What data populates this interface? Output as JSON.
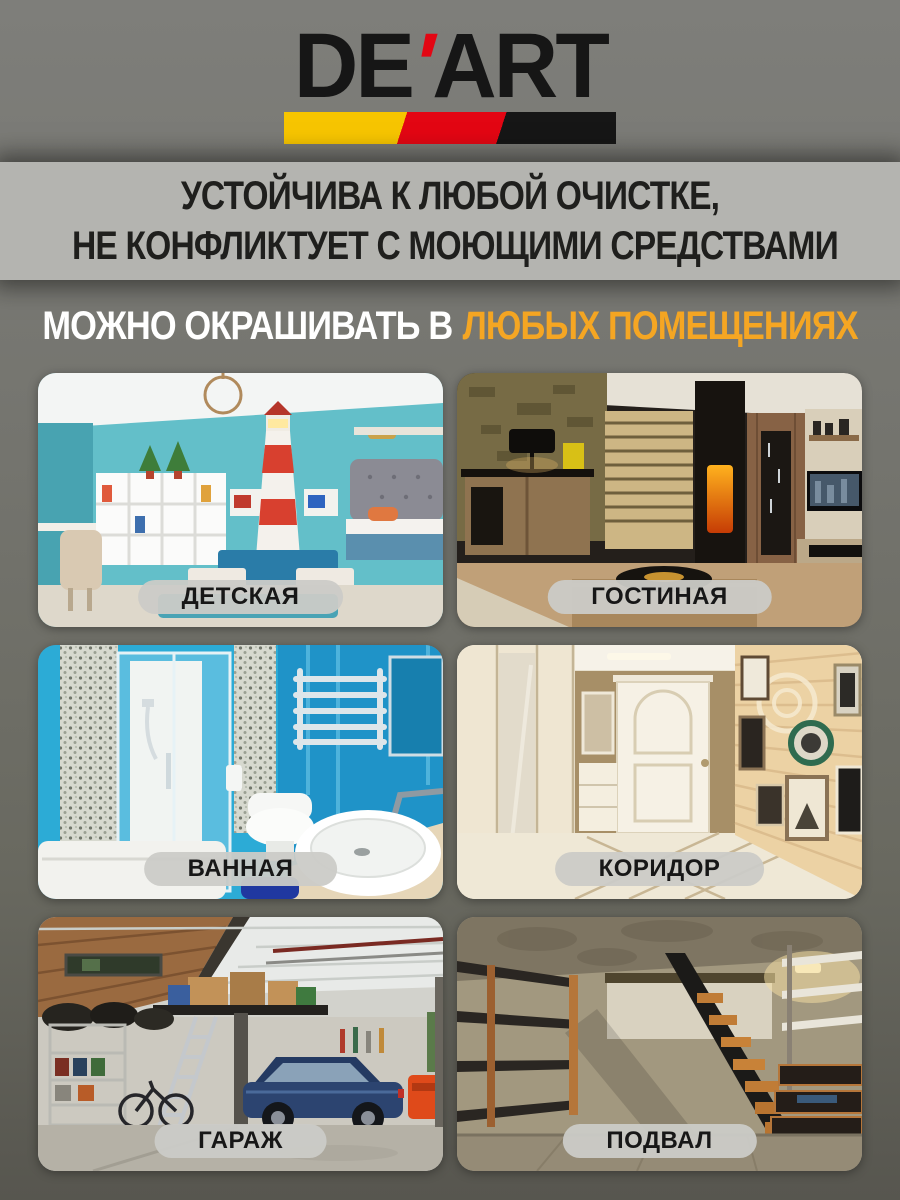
{
  "brand": {
    "name_left": "DE",
    "apostrophe": "'",
    "name_right": "ART",
    "stripe_colors": {
      "yellow": "#F7C500",
      "red": "#E30613",
      "black": "#161616"
    }
  },
  "claim_banner": {
    "line1": "УСТОЙЧИВА К ЛЮБОЙ ОЧИСТКЕ,",
    "line2": "НЕ КОНФЛИКТУЕТ С МОЮЩИМИ СРЕДСТВАМИ"
  },
  "headline": {
    "white_part": "МОЖНО ОКРАШИВАТЬ В",
    "orange_part": "ЛЮБЫХ ПОМЕЩЕНИЯХ",
    "orange_color": "#F5A623"
  },
  "rooms": [
    {
      "label": "ДЕТСКАЯ"
    },
    {
      "label": "ГОСТИНАЯ"
    },
    {
      "label": "ВАННАЯ"
    },
    {
      "label": "КОРИДОР"
    },
    {
      "label": "ГАРАЖ"
    },
    {
      "label": "ПОДВАЛ"
    }
  ]
}
